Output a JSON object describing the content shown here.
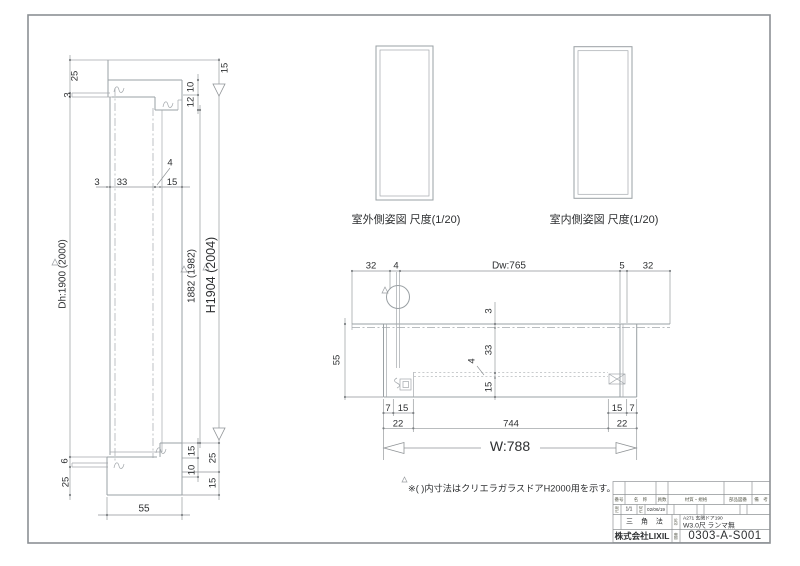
{
  "colors": {
    "line": "#9aa0a4",
    "dim": "#8f9396",
    "text": "#2d2f31"
  },
  "lv": {
    "t25": "25",
    "t3": "3",
    "t15": "15",
    "t10": "10",
    "t12": "12",
    "m4": "4",
    "m3": "3",
    "m33": "33",
    "m15": "15",
    "dh": "Dh:1900 (2000)",
    "h_in": "1882 (1982)",
    "h_out": "H1904 (2004)",
    "b6": "6",
    "b25": "25",
    "b15a": "15",
    "b10": "10",
    "b25b": "25",
    "b15b": "15",
    "b55": "55"
  },
  "elev": {
    "outside": "室外側姿図 尺度(1/20)",
    "inside": "室内側姿図 尺度(1/20)"
  },
  "pv": {
    "t32l": "32",
    "t4": "4",
    "dw": "Dw:765",
    "t5": "5",
    "t32r": "32",
    "v3": "3",
    "v33": "33",
    "v4": "4",
    "v15": "15",
    "v55": "55",
    "b7l": "7",
    "b15l": "15",
    "b15r": "15",
    "b7r": "7",
    "b22l": "22",
    "b744": "744",
    "b22r": "22",
    "w": "W:788"
  },
  "note": "※( )内寸法はクリエラガラスドアH2000用を示す。",
  "tb": {
    "h1": "番号",
    "h2": "名　称",
    "h3": "員数",
    "h4": "材質・規格",
    "h5": "部品図番",
    "h6": "備　考",
    "l_scale": "尺度",
    "scale": "1/1",
    "l_date": "作成",
    "date": "02/06/19",
    "proj": "三 角 法",
    "l_name": "名称",
    "p1": "A271 玄関ドア190",
    "p2": "W3.0尺 ランマ無",
    "co": "株式会社LIXIL",
    "l_no": "図番",
    "no": "0303-A-S001"
  }
}
